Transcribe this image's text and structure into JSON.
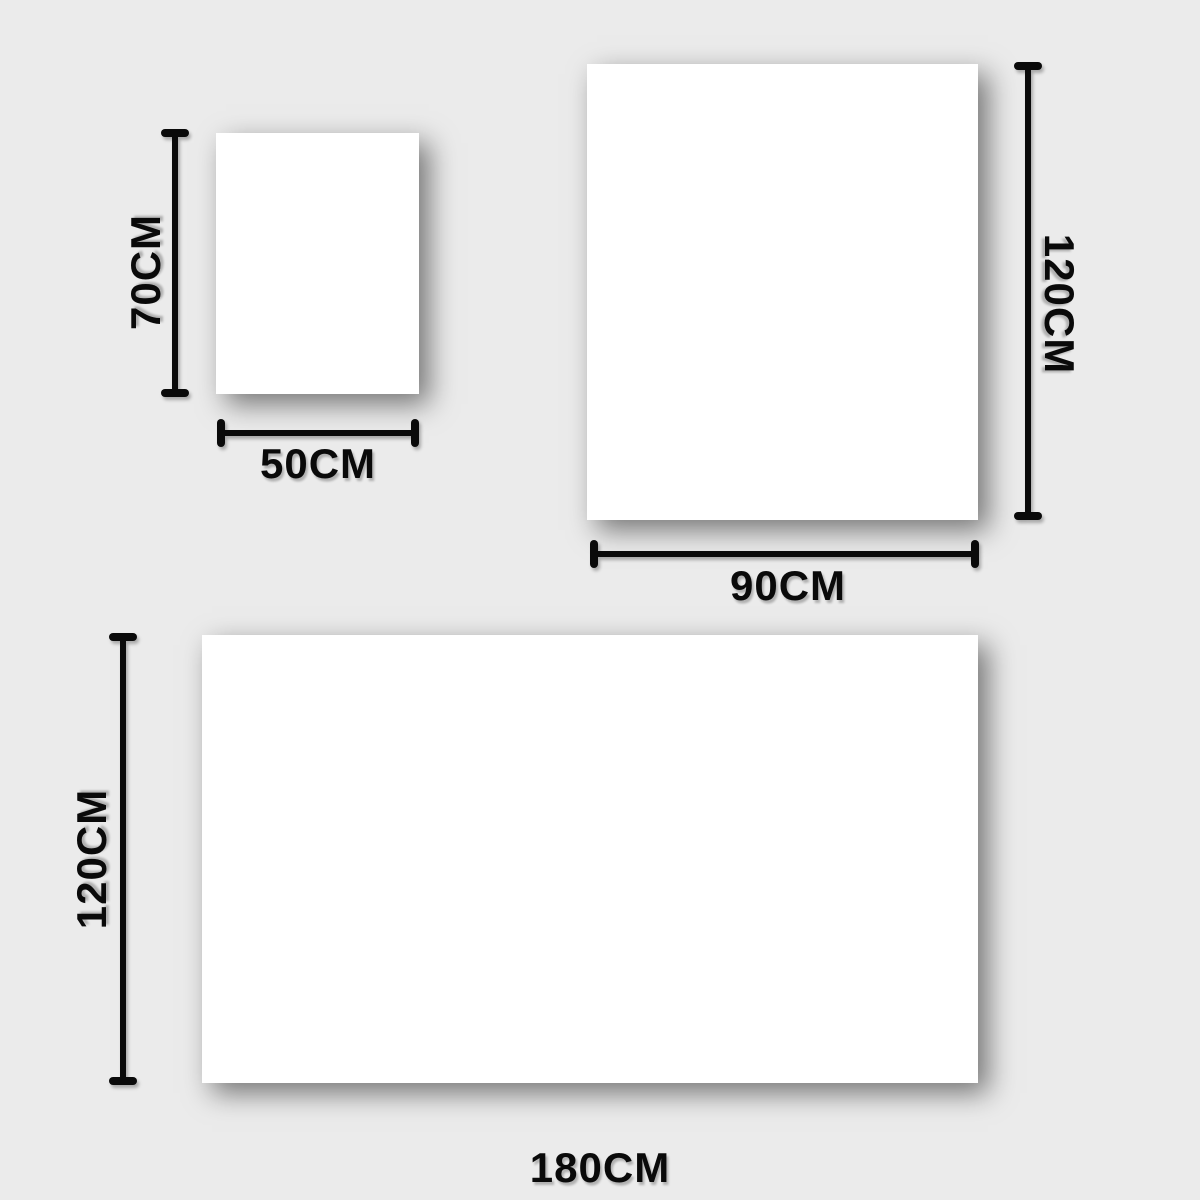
{
  "diagram": {
    "title": "size-comparison-diagram",
    "background_color": "#ebebeb",
    "shape_fill_color": "#ffffff",
    "line_color": "#0a0a0a",
    "sizes": [
      {
        "name": "small",
        "height_label": "70CM",
        "width_label": "50CM"
      },
      {
        "name": "medium",
        "height_label": "120CM",
        "width_label": "90CM"
      },
      {
        "name": "large",
        "height_label": "120CM",
        "width_label": "180CM"
      }
    ]
  }
}
